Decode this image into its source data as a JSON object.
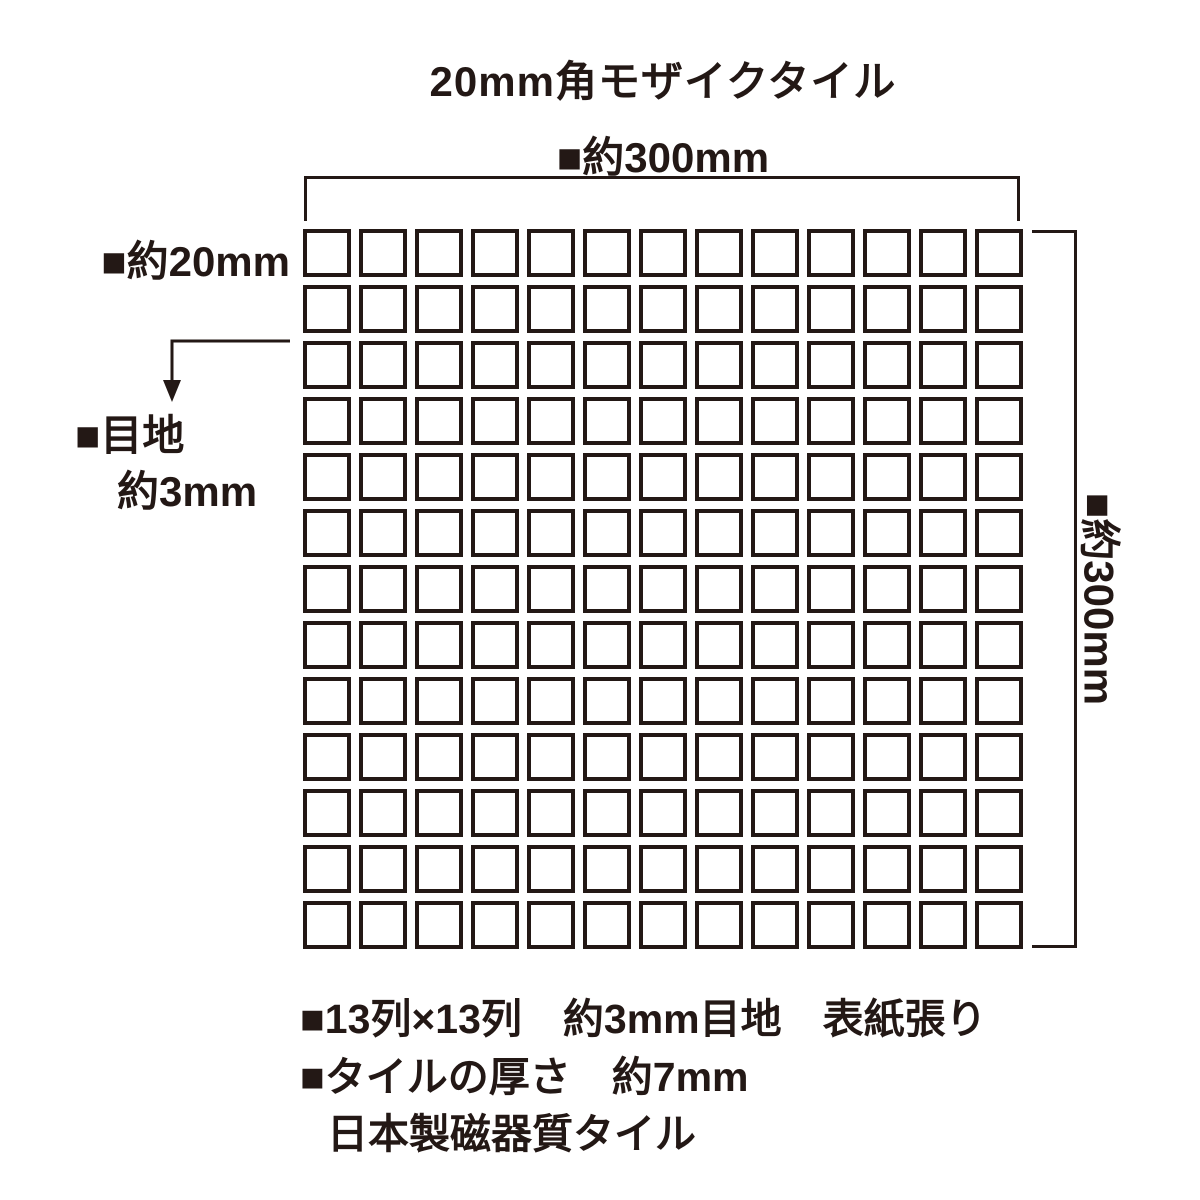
{
  "title": "20mm角モザイクタイル",
  "colors": {
    "ink": "#231815",
    "background": "#ffffff"
  },
  "dimensions": {
    "top_width_label": "■約300mm",
    "right_height_label": "■約300mm",
    "tile_size_label": "■約20mm",
    "joint_label_line1": "■目地",
    "joint_label_line2": "約3mm"
  },
  "grid": {
    "rows": 13,
    "cols": 13,
    "tile_shape": "square"
  },
  "notes": [
    "■13列×13列　約3mm目地　表紙張り",
    "■タイルの厚さ　約7mm",
    "日本製磁器質タイル"
  ]
}
